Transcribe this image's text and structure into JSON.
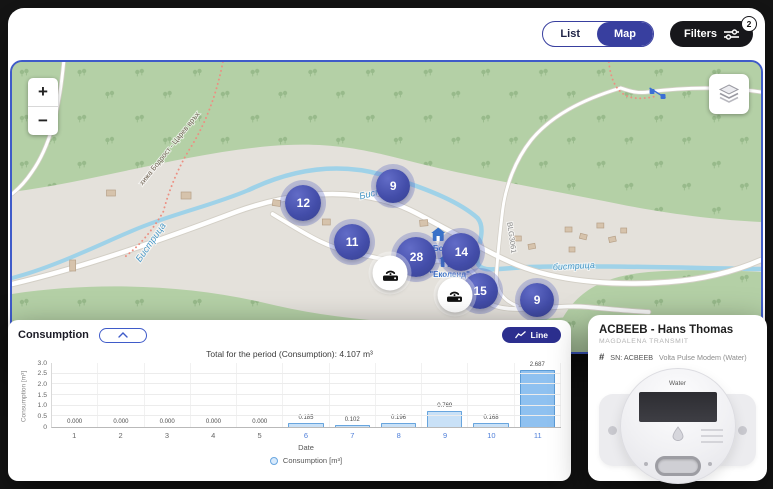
{
  "header": {
    "list_label": "List",
    "map_label": "Map",
    "filters_label": "Filters",
    "filters_badge": "2"
  },
  "map": {
    "zoom_in_label": "+",
    "zoom_out_label": "−",
    "labels": {
      "river_left": "Бистрица",
      "river_top": "Бистрица",
      "river_right": "бистрица",
      "road_ref": "BLG3061",
      "trail": "хижа Бодрост - Царев връх",
      "poi_bodrost": "Бодрост",
      "poi_ecoland": "\"Еколенд\""
    },
    "markers": [
      {
        "count": "12",
        "x_pct": 38.9,
        "y_pct": 48.6,
        "size": 36
      },
      {
        "count": "9",
        "x_pct": 50.9,
        "y_pct": 42.8,
        "size": 34
      },
      {
        "count": "11",
        "x_pct": 45.4,
        "y_pct": 62.1,
        "size": 36
      },
      {
        "count": "28",
        "x_pct": 54.0,
        "y_pct": 67.2,
        "size": 40
      },
      {
        "count": "14",
        "x_pct": 60.0,
        "y_pct": 65.5,
        "size": 38
      },
      {
        "count": "15",
        "x_pct": 62.5,
        "y_pct": 79.0,
        "size": 36
      },
      {
        "count": "9",
        "x_pct": 70.1,
        "y_pct": 82.1,
        "size": 34
      }
    ],
    "gateways": [
      {
        "x_pct": 50.5,
        "y_pct": 72.8
      },
      {
        "x_pct": 59.1,
        "y_pct": 80.3
      }
    ]
  },
  "consumption_panel": {
    "title": "Consumption",
    "line_button_label": "Line"
  },
  "chart_data": {
    "type": "bar",
    "title": "Total for the period (Consumption): 4.107 m³",
    "categories": [
      "1",
      "2",
      "3",
      "4",
      "5",
      "6",
      "7",
      "8",
      "9",
      "10",
      "11"
    ],
    "values": [
      0,
      0,
      0,
      0,
      0,
      0.185,
      0.102,
      0.196,
      0.769,
      0.168,
      2.687
    ],
    "value_labels": [
      "0.000",
      "0.000",
      "0.000",
      "0.000",
      "0.000",
      "0.185",
      "0.102",
      "0.196",
      "0.769",
      "0.168",
      "2.687"
    ],
    "total_for_period": "4.107 m³",
    "xlabel": "Date",
    "ylabel": "Consumption [m³]",
    "ylim": [
      0,
      3
    ],
    "yticks": [
      0,
      0.5,
      1,
      1.5,
      2,
      2.5,
      3
    ],
    "ytick_labels": [
      "0",
      "0.5",
      "1.0",
      "1.5",
      "2.0",
      "2.5",
      "3.0"
    ],
    "legend": [
      "Consumption [m³]"
    ],
    "legend_position": "bottom",
    "grid": true
  },
  "device_panel": {
    "title": "ACBEEB - Hans Thomas",
    "subtitle": "MAGDALENA TRANSMIT",
    "hash_icon": "#",
    "serial_label": "SN: ACBEEB",
    "model_label": "Volta Pulse Modem (Water)",
    "meter_label": "Water"
  },
  "colors": {
    "accent_indigo": "#383f9f",
    "line_button": "#2c2f8f",
    "map_border": "#3f5bc9",
    "marker_fill": "#434da9",
    "filters_black": "#17171b",
    "bar_fill": "#c9e1f7",
    "bar_border": "#68a5de",
    "bar_highlight": "#8fc1f0",
    "active_tick": "#4f7fd9",
    "map_green": "#b4d0a6",
    "map_gray": "#e4e1db",
    "river_blue": "#9fd2e8"
  }
}
